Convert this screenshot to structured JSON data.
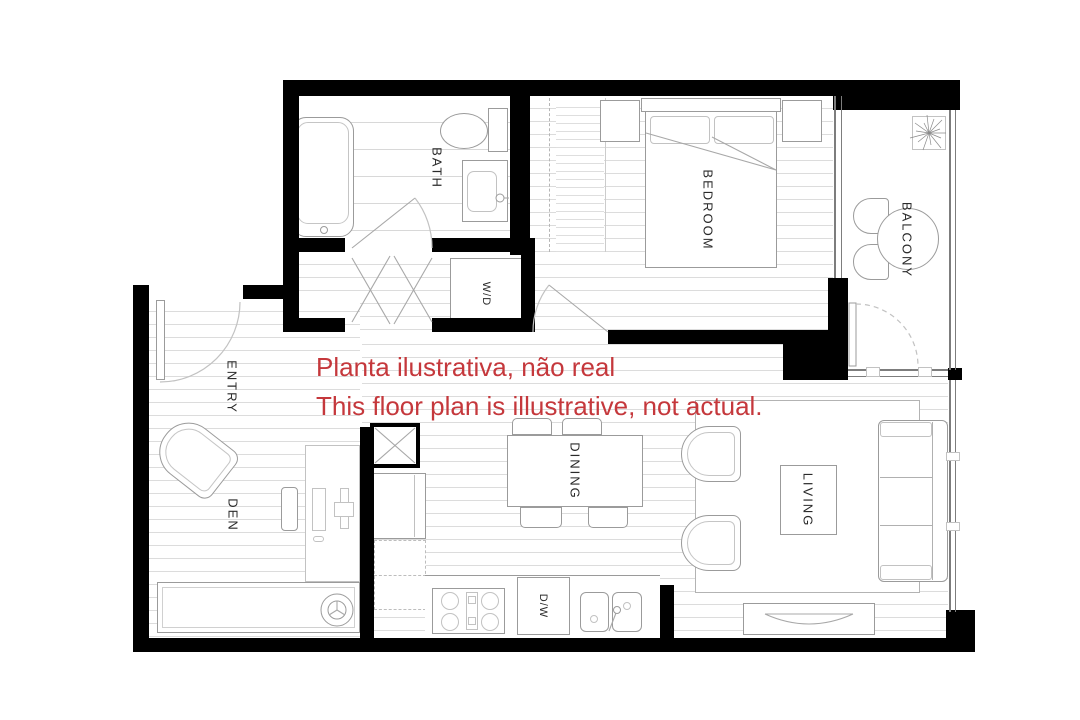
{
  "disclaimer": {
    "line1": "Planta ilustrativa, não real",
    "line2": "This floor plan is illustrative, not actual."
  },
  "rooms": {
    "bath": "BATH",
    "bedroom": "BEDROOM",
    "balcony": "BALCONY",
    "entry": "ENTRY",
    "den": "DEN",
    "dining": "DINING",
    "living": "LIVING"
  },
  "appliances": {
    "washer_dryer": "W/D",
    "dishwasher": "D/W"
  },
  "colors": {
    "wall": "#000000",
    "floor_stripe": "#dcdcdc",
    "furniture_line": "#9b9b9b",
    "window_line": "#7d7d7d",
    "disclaimer_red": "#c5383c"
  }
}
